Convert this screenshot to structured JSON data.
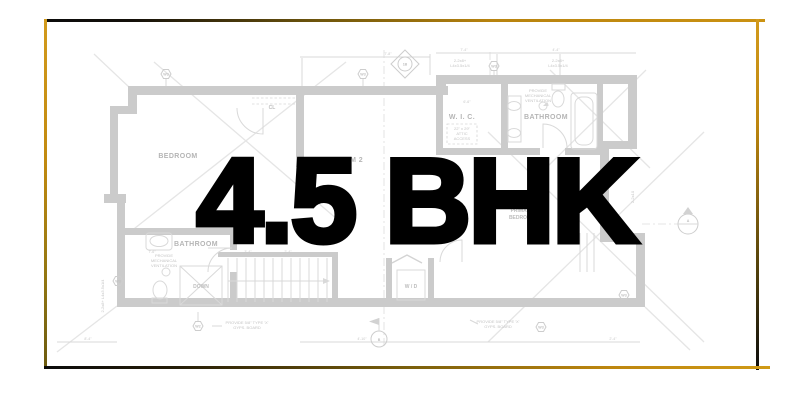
{
  "title": {
    "text": "4.5 BHK"
  },
  "theme": {
    "gold": "#c8890e",
    "black": "#0c0c0c",
    "plan_wall_gray": "#cbcbcb",
    "plan_line_gray": "#d9d9d9",
    "plan_text_gray": "#b5b5b5",
    "title_color": "#000000",
    "background": "#ffffff"
  },
  "blueprint": {
    "rooms": {
      "bedroom": "BEDROOM",
      "bedroom2": "BEDROOM 2",
      "wic": "W. I. C.",
      "bathroom_top": "BATHROOM",
      "bathroom_bottom": "BATHROOM",
      "primary_line1": "PRIMARY",
      "primary_line2": "BEDROOM",
      "closet": "CL",
      "washer_dryer": "W / D",
      "down": "DOWN"
    },
    "notes": {
      "beam_line1": "2-2x8+",
      "beam_line2": "L4x3.5x1/4",
      "beam_left_rotated": "2-2x8+ L4x3.5x1/4",
      "joist_right_rotated": "2-2x10",
      "gyp_line1": "PROVIDE 5/8\" TYPE 'X'",
      "gyp_line2": "GYPS. BOARD",
      "vent_line1": "PROVIDE",
      "vent_line2": "MECHANICAL",
      "vent_line3": "VENTILATION",
      "attic_line1": "22\" x 29\"",
      "attic_line2": "ATTIC",
      "attic_line3": "ACCESS"
    },
    "markers": {
      "w3": "W3",
      "w2": "W2",
      "section_a": "A",
      "datum_b": "B",
      "tag_1b": "1B"
    },
    "dims": {
      "d1": "7'-8\"",
      "d2": "7'-4\"",
      "d3": "4'-4\"",
      "d4": "6'-6\"",
      "d5": "7'-6\"",
      "d6": "3'-4\"",
      "d7": "2'-4\"",
      "d8": "4'-10\"",
      "d9": "8'-4\""
    }
  }
}
